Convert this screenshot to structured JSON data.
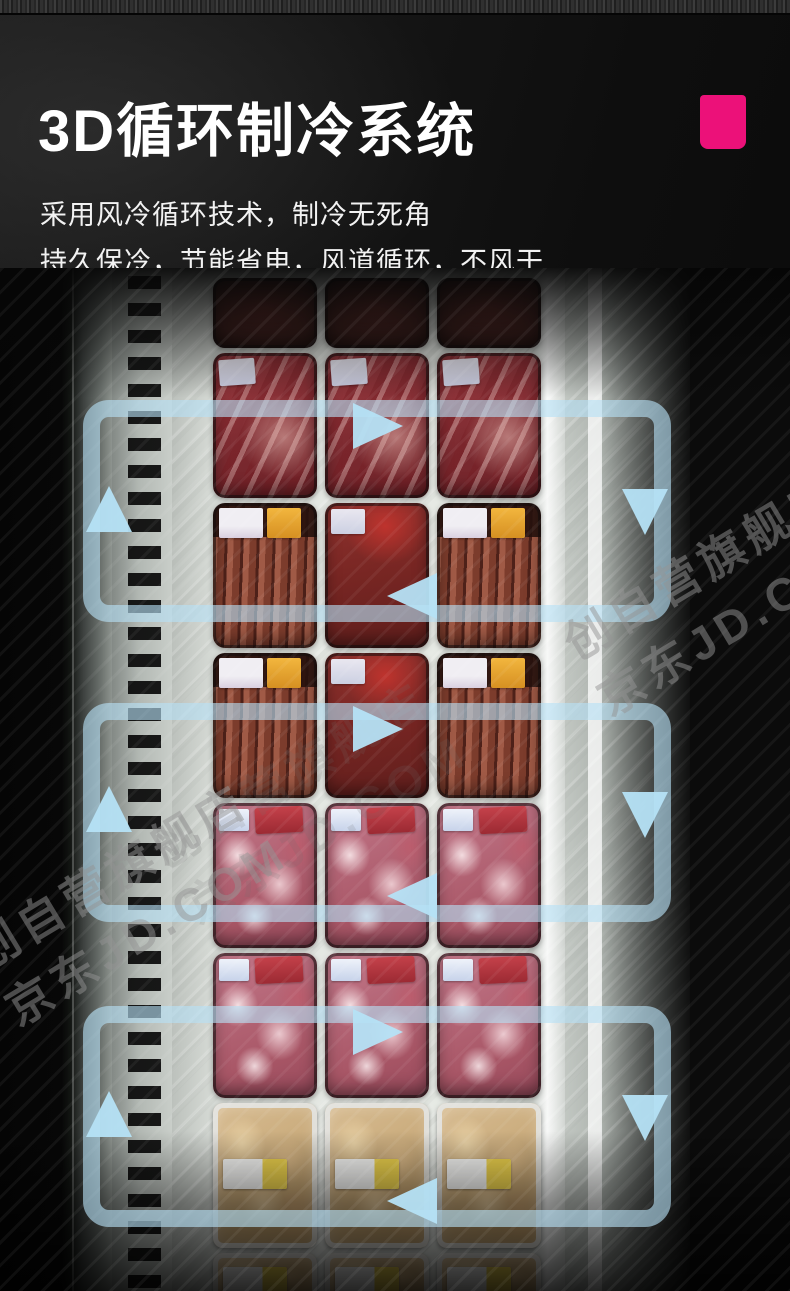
{
  "banner": {
    "title": "3D循环制冷系统",
    "subtitle_lines": [
      "采用风冷循环技术，制冷无死角",
      "持久保冷，节能省电，风道循环，不风干"
    ],
    "accent_color": "#EC1179"
  },
  "diagram": {
    "arrow_color": "#B5E1F6",
    "loop_count": 3,
    "flow_directions": [
      "right",
      "down",
      "left",
      "up"
    ]
  },
  "watermark": {
    "line1": "创自营旗舰店",
    "line2": "京东JD.COM"
  }
}
